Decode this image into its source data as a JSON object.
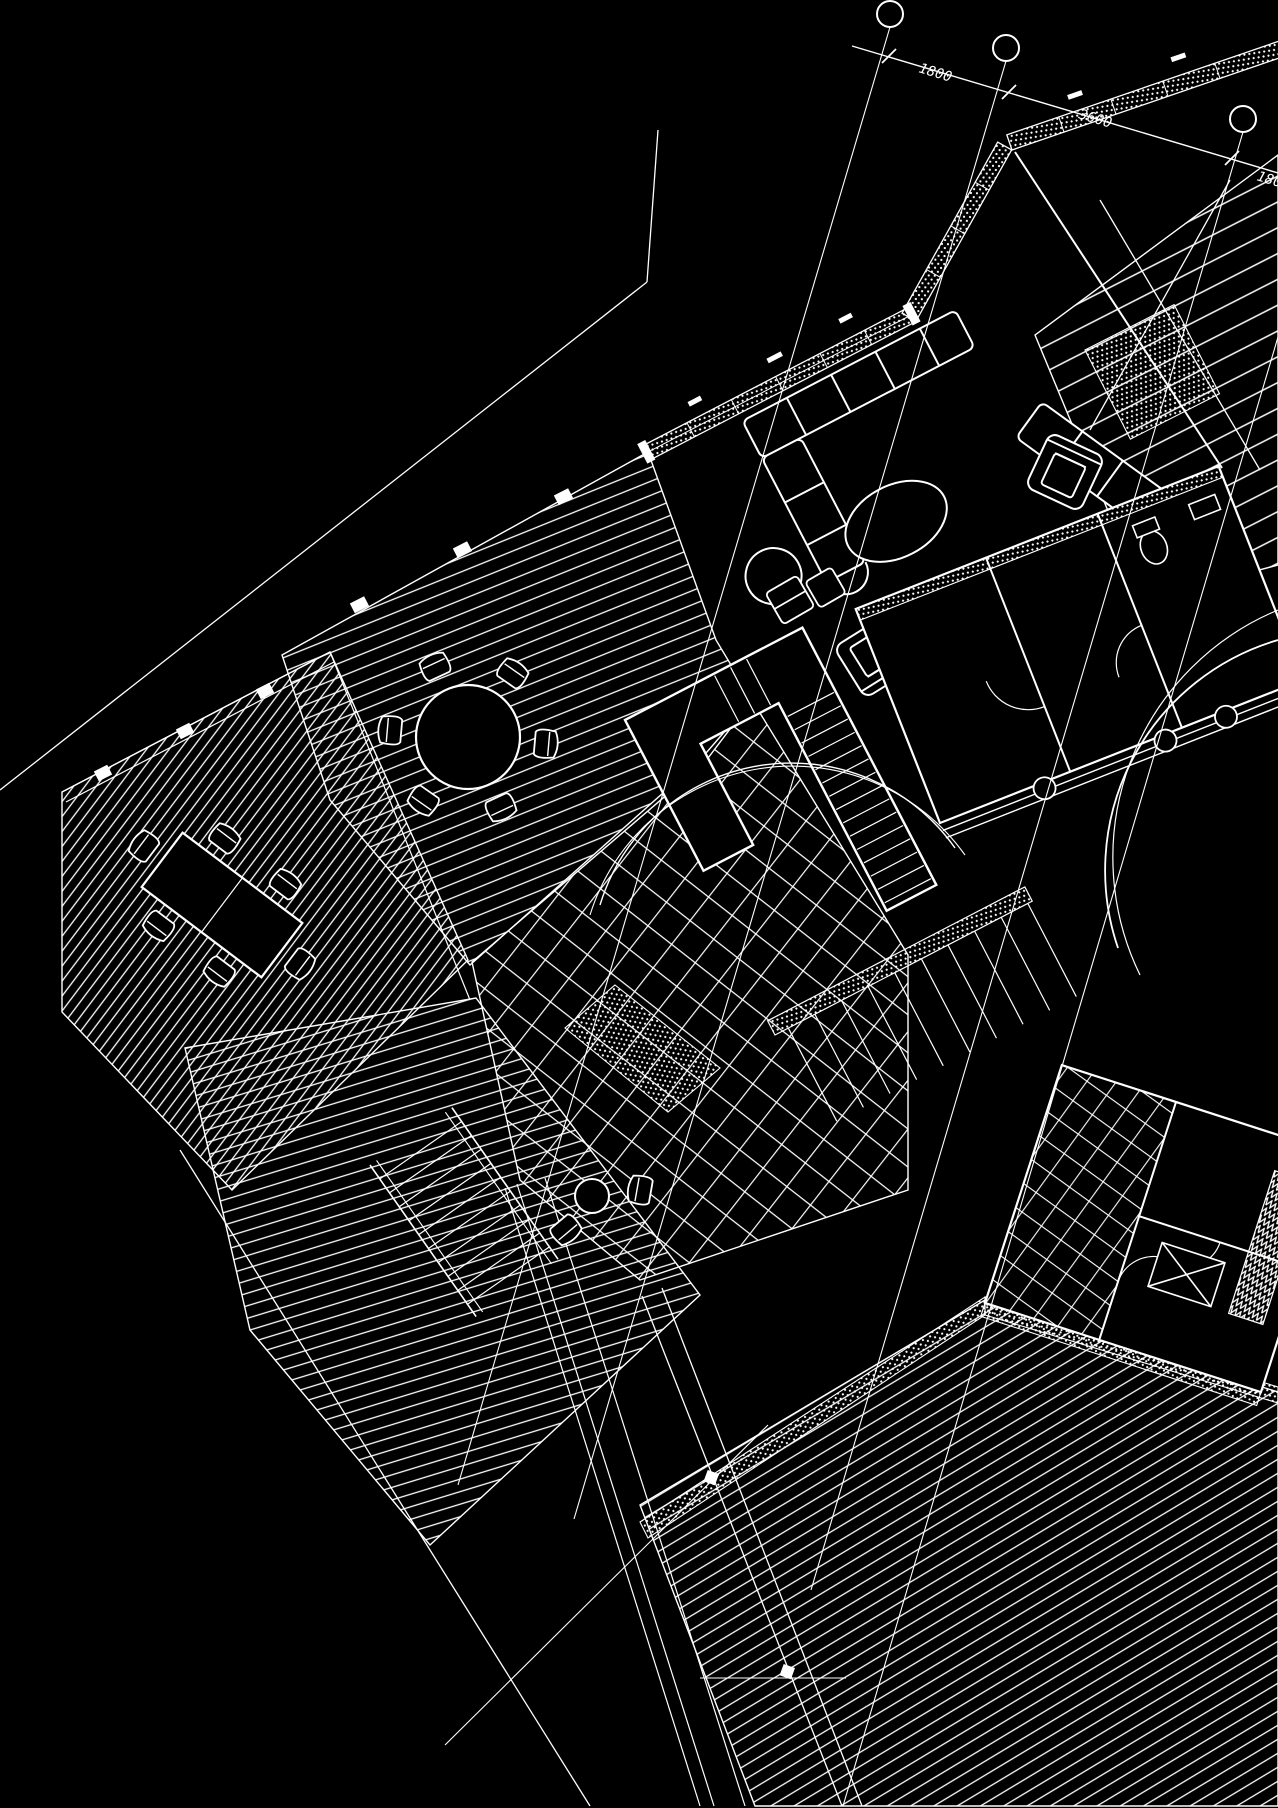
{
  "palette": {
    "background": "#000000",
    "ink": "#ffffff"
  },
  "dimension_chain": {
    "labels": [
      {
        "text": "1800"
      },
      {
        "text": "3600"
      },
      {
        "text": "1800"
      }
    ]
  },
  "grid_bubbles": {
    "count": 3
  }
}
